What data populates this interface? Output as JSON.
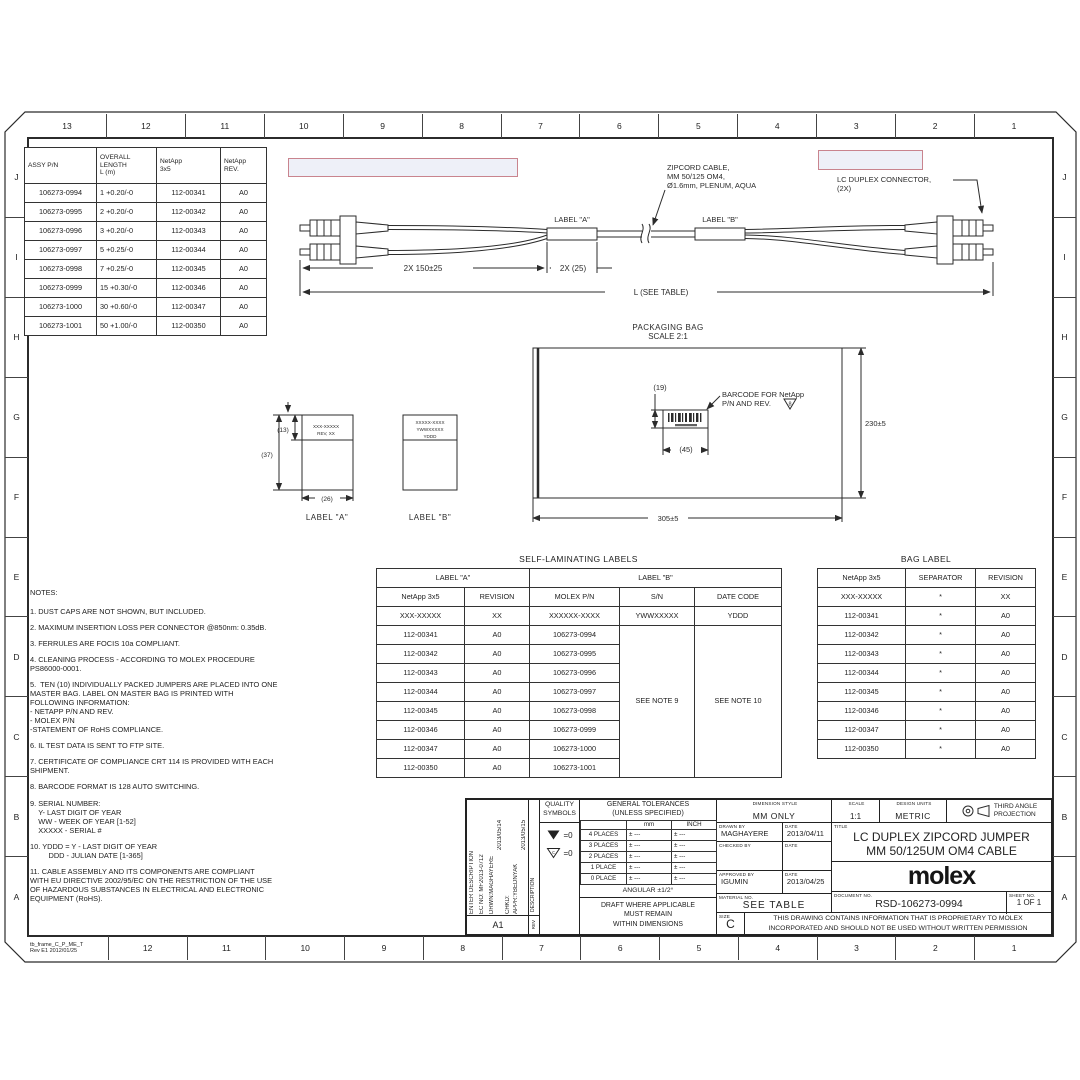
{
  "colors": {
    "line": "#2b2b2b",
    "redaction_border": "#c9848e",
    "redaction_fill": "#eef0f8"
  },
  "frame": {
    "top_numbers": [
      "13",
      "12",
      "11",
      "10",
      "9",
      "8",
      "7",
      "6",
      "5",
      "4",
      "3",
      "2",
      "1"
    ],
    "bottom_numbers": [
      "12",
      "11",
      "10",
      "9",
      "8",
      "7",
      "6",
      "5",
      "4",
      "3",
      "2",
      "1"
    ],
    "side_letters": [
      "J",
      "I",
      "H",
      "G",
      "F",
      "E",
      "D",
      "C",
      "B",
      "A"
    ],
    "frame_label": "tb_frame_C_P_ME_T\nRev E1 2012/01/25"
  },
  "assy_table": {
    "headers": [
      "ASSY P/N",
      "OVERALL\nLENGTH\nL (m)",
      "NetApp\n3x5",
      "NetApp\nREV."
    ],
    "rows": [
      [
        "106273-0994",
        "1 +0.20/-0",
        "112-00341",
        "A0"
      ],
      [
        "106273-0995",
        "2 +0.20/-0",
        "112-00342",
        "A0"
      ],
      [
        "106273-0996",
        "3 +0.20/-0",
        "112-00343",
        "A0"
      ],
      [
        "106273-0997",
        "5 +0.25/-0",
        "112-00344",
        "A0"
      ],
      [
        "106273-0998",
        "7 +0.25/-0",
        "112-00345",
        "A0"
      ],
      [
        "106273-0999",
        "15 +0.30/-0",
        "112-00346",
        "A0"
      ],
      [
        "106273-1000",
        "30 +0.60/-0",
        "112-00347",
        "A0"
      ],
      [
        "106273-1001",
        "50 +1.00/-0",
        "112-00350",
        "A0"
      ]
    ]
  },
  "cable": {
    "zipcord_callout": [
      "ZIPCORD CABLE,",
      "MM 50/125 OM4,",
      "Ø1.6mm, PLENUM, AQUA"
    ],
    "connector_callout": [
      "LC DUPLEX CONNECTOR,",
      "(2X)"
    ],
    "label_a": "LABEL \"A\"",
    "label_b": "LABEL \"B\"",
    "dim_150": "2X  150±25",
    "dim_25": "2X (25)",
    "dim_l": "L (SEE TABLE)"
  },
  "bag": {
    "title": "PACKAGING BAG",
    "scale": "SCALE 2:1",
    "dim_19": "(19)",
    "dim_45": "(45)",
    "dim_230": "230±5",
    "dim_305": "305±5",
    "barcode_callout": [
      "BARCODE FOR NetApp",
      "P/N AND REV."
    ],
    "flag_note": "8"
  },
  "labels": {
    "a_line1": "XXX-XXXXX",
    "a_line2": "REV, XX",
    "b_line1": "XXXXX-XXXX",
    "b_line2": "YWWXXXXX",
    "b_line3": "YDDD",
    "dim_13": "(13)",
    "dim_37": "(37)",
    "dim_26": "(26)",
    "caption_a": "LABEL \"A\"",
    "caption_b": "LABEL \"B\""
  },
  "self_lam": {
    "title": "SELF-LAMINATING LABELS",
    "group_a": "LABEL \"A\"",
    "group_b": "LABEL \"B\"",
    "headers": [
      "NetApp 3x5",
      "REVISION",
      "MOLEX P/N",
      "S/N",
      "DATE CODE"
    ],
    "placeholder": [
      "XXX-XXXXX",
      "XX",
      "XXXXXX-XXXX",
      "YWWXXXXX",
      "YDDD"
    ],
    "rows": [
      [
        "112-00341",
        "A0",
        "106273-0994"
      ],
      [
        "112-00342",
        "A0",
        "106273-0995"
      ],
      [
        "112-00343",
        "A0",
        "106273-0996"
      ],
      [
        "112-00344",
        "A0",
        "106273-0997"
      ],
      [
        "112-00345",
        "A0",
        "106273-0998"
      ],
      [
        "112-00346",
        "A0",
        "106273-0999"
      ],
      [
        "112-00347",
        "A0",
        "106273-1000"
      ],
      [
        "112-00350",
        "A0",
        "106273-1001"
      ]
    ],
    "sn_note": "SEE NOTE 9",
    "date_note": "SEE NOTE 10"
  },
  "bag_label_table": {
    "title": "BAG LABEL",
    "headers": [
      "NetApp 3x5",
      "SEPARATOR",
      "REVISION"
    ],
    "rows": [
      [
        "XXX-XXXXX",
        "*",
        "XX"
      ],
      [
        "112-00341",
        "*",
        "A0"
      ],
      [
        "112-00342",
        "*",
        "A0"
      ],
      [
        "112-00343",
        "*",
        "A0"
      ],
      [
        "112-00344",
        "*",
        "A0"
      ],
      [
        "112-00345",
        "*",
        "A0"
      ],
      [
        "112-00346",
        "*",
        "A0"
      ],
      [
        "112-00347",
        "*",
        "A0"
      ],
      [
        "112-00350",
        "*",
        "A0"
      ]
    ]
  },
  "notes": {
    "title": "NOTES:",
    "items": [
      "1. DUST CAPS ARE NOT SHOWN, BUT INCLUDED.",
      "2. MAXIMUM INSERTION LOSS PER CONNECTOR @850nm: 0.35dB.",
      "3. FERRULES ARE FOCIS 10a COMPLIANT.",
      "4. CLEANING PROCESS - ACCORDING TO MOLEX PROCEDURE\nPS86000-0001.",
      "5.  TEN (10) INDIVIDUALLY PACKED JUMPERS ARE PLACED INTO ONE\nMASTER BAG. LABEL ON MASTER BAG IS PRINTED WITH\nFOLLOWING INFORMATION:\n- NETAPP P/N AND REV.\n- MOLEX P/N\n-STATEMENT OF RoHS COMPLIANCE.",
      "6. IL TEST DATA IS SENT TO FTP SITE.",
      "7. CERTIFICATE OF COMPLIANCE CRT 114 IS PROVIDED WITH EACH\nSHIPMENT.",
      "8. BARCODE FORMAT IS 128 AUTO SWITCHING.",
      "9. SERIAL NUMBER:\n    Y- LAST DIGIT OF YEAR\n    WW - WEEK OF YEAR [1-52]\n    XXXXX - SERIAL #",
      "10. YDDD = Y - LAST DIGIT OF YEAR\n         DDD - JULIAN DATE [1-365]",
      "11. CABLE ASSEMBLY AND ITS COMPONENTS ARE COMPLIANT\nWITH EU DIRECTIVE 2002/95/EC ON THE RESTRICTION OF THE USE\nOF HAZARDOUS SUBSTANCES IN ELECTRICAL AND ELECTRONIC\nEQUIPMENT (RoHS)."
    ]
  },
  "titleblock": {
    "revision": {
      "cols": [
        "ENTER DESCRIPTION",
        "EC NO: MF2013-0712",
        "DRWN:MAGHAYERE",
        "2013/05/14",
        "CHKD:",
        "APPR:YBEDNYAK",
        "2013/05/15"
      ],
      "rev_id": "A1",
      "description_label": "DESCRIPTION",
      "rev_label": "REV"
    },
    "quality": {
      "heading": "QUALITY\nSYMBOLS",
      "sym1_value": "=0",
      "sym2_letter": "c",
      "sym2_value": "=0"
    },
    "tolerances": {
      "heading": "GENERAL TOLERANCES\n(UNLESS SPECIFIED)",
      "col_mm": "mm",
      "col_inch": "INCH",
      "rows": [
        "4 PLACES",
        "3 PLACES",
        "2 PLACES",
        "1 PLACE",
        "0 PLACE"
      ],
      "tol": "± ---",
      "angular": "ANGULAR ±1/2°",
      "draft": "DRAFT WHERE APPLICABLE\nMUST REMAIN\nWITHIN DIMENSIONS"
    },
    "info": {
      "dimension_style_label": "DIMENSION STYLE",
      "dimension_style": "MM ONLY",
      "drawn_by_label": "DRAWN BY",
      "drawn_by": "MAGHAYERE",
      "drawn_date_label": "DATE",
      "drawn_date": "2013/04/11",
      "checked_by_label": "CHECKED BY",
      "checked_date_label": "DATE",
      "approved_by_label": "APPROVED BY",
      "approved_by": "IGUMIN",
      "approved_date_label": "DATE",
      "approved_date": "2013/04/25",
      "material_label": "MATERIAL NO.",
      "material": "SEE TABLE",
      "size_label": "SIZE",
      "size": "C"
    },
    "right": {
      "scale_label": "SCALE",
      "scale": "1:1",
      "units_label": "DESIGN UNITS",
      "units": "METRIC",
      "projection": "THIRD ANGLE\nPROJECTION",
      "title_label": "TITLE",
      "title": "LC DUPLEX ZIPCORD JUMPER\nMM 50/125UM OM4 CABLE",
      "logo": "molex",
      "document_label": "DOCUMENT NO.",
      "document": "RSD-106273-0994",
      "sheet_label": "SHEET NO.",
      "sheet": "1 OF 1",
      "proprietary": "THIS DRAWING CONTAINS INFORMATION THAT IS PROPRIETARY TO MOLEX\nINCORPORATED AND SHOULD NOT BE USED WITHOUT WRITTEN PERMISSION"
    }
  }
}
